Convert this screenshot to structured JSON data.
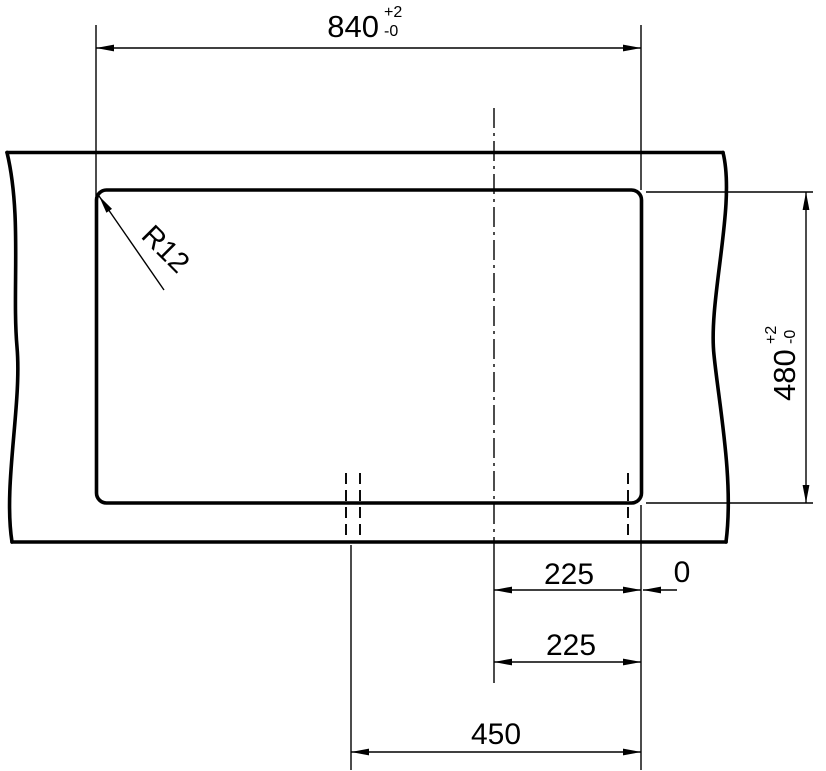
{
  "colors": {
    "line": "#000000",
    "background": "#ffffff"
  },
  "drawing": {
    "width_dim": {
      "value": "840",
      "tol_plus": "+2",
      "tol_minus": "-0"
    },
    "height_dim": {
      "value": "480",
      "tol_plus": "+2",
      "tol_minus": "-0"
    },
    "corner_radius_label": "R12",
    "offset_dim_upper": "225",
    "datum_label": "0",
    "offset_dim_lower": "225",
    "span_dim": "450"
  }
}
